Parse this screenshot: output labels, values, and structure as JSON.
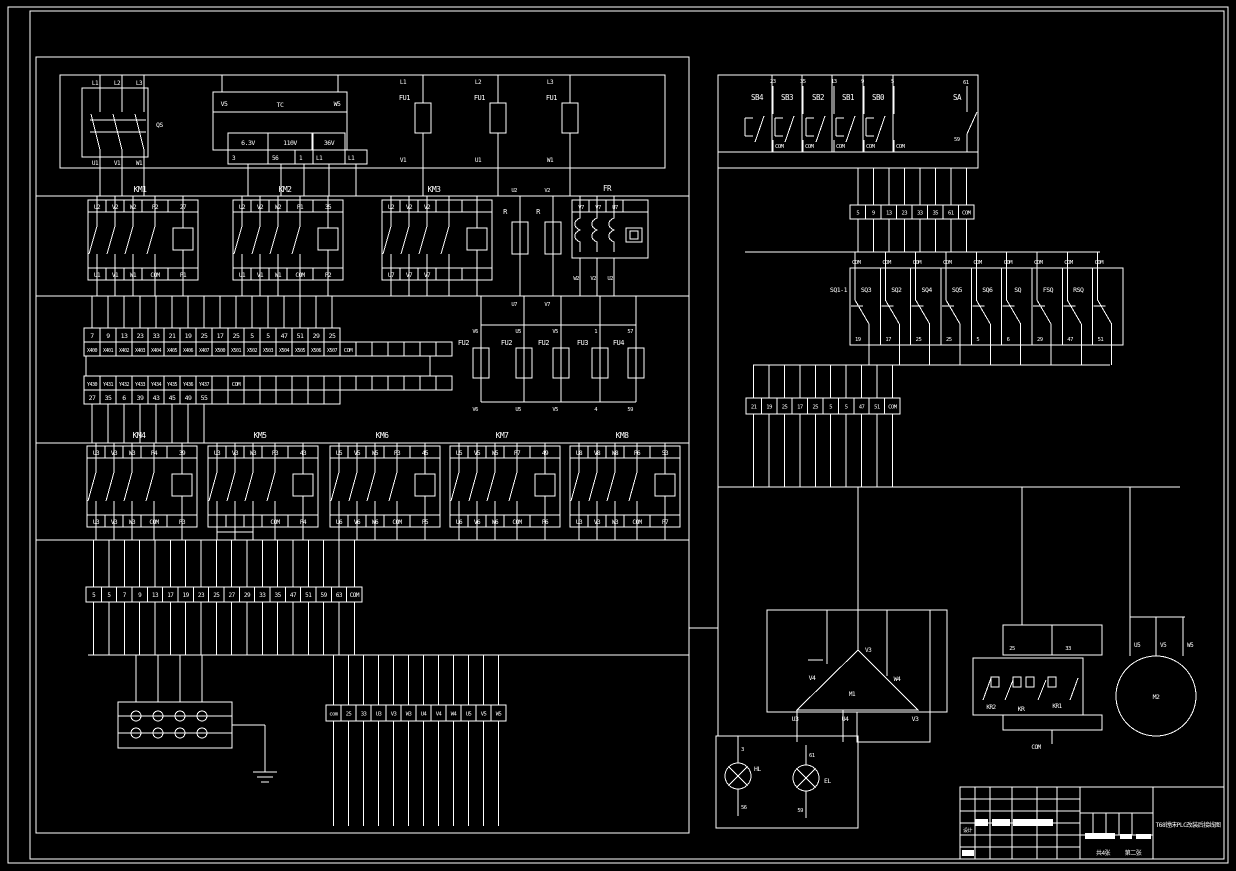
{
  "drawing": {
    "colors": {
      "background": "#000000",
      "line": "#ffffff"
    },
    "left": {
      "qs": {
        "label": "QS",
        "top": [
          "L1",
          "L2",
          "L3"
        ],
        "bottom": [
          "U1",
          "V1",
          "W1"
        ]
      },
      "tc": {
        "label": "TC",
        "left_terminal": "V5",
        "right_terminal": "W5",
        "taps": [
          "6.3V",
          "110V",
          "36V"
        ],
        "terminals": [
          "3",
          "56",
          "1",
          "L1",
          "L1"
        ]
      },
      "fu1": {
        "labels": [
          "FU1",
          "FU1",
          "FU1"
        ],
        "tops": [
          "L1",
          "L2",
          "L3"
        ],
        "bottoms": [
          "V1",
          "U1",
          "W1"
        ]
      },
      "km_row1": [
        {
          "label": "KM1",
          "top": [
            "U2",
            "V2",
            "W2",
            "P2",
            "27"
          ],
          "bottom": [
            "U1",
            "V1",
            "W1",
            "COM",
            "P1"
          ]
        },
        {
          "label": "KM2",
          "top": [
            "U2",
            "V2",
            "W2",
            "P1",
            "35"
          ],
          "bottom": [
            "U1",
            "V1",
            "W1",
            "COM",
            "P2"
          ]
        },
        {
          "label": "KM3",
          "top": [
            "U2",
            "V2",
            "V2",
            "",
            ""
          ],
          "bottom": [
            "U7",
            "V7",
            "V7",
            "",
            ""
          ]
        }
      ],
      "resistors": [
        {
          "label": "R",
          "top": "U2",
          "bottom": "U7"
        },
        {
          "label": "R",
          "top": "V2",
          "bottom": "V7"
        }
      ],
      "fr": {
        "label": "FR",
        "top": [
          "V7",
          "V7",
          "U7"
        ],
        "bottom": [
          "W2",
          "V2",
          "U2"
        ]
      },
      "plc": {
        "top_numbers": [
          "7",
          "9",
          "13",
          "23",
          "33",
          "21",
          "19",
          "25",
          "17",
          "25",
          "5",
          "5",
          "47",
          "51",
          "29",
          "25"
        ],
        "x_labels": [
          "X400",
          "X401",
          "X402",
          "X403",
          "X404",
          "X405",
          "X406",
          "X407",
          "X500",
          "X501",
          "X502",
          "X503",
          "X504",
          "X505",
          "X506",
          "X507"
        ],
        "x_com": "COM",
        "y_labels": [
          "Y430",
          "Y431",
          "Y432",
          "Y433",
          "Y434",
          "Y435",
          "Y436",
          "Y437"
        ],
        "y_com": "COM",
        "bottom_numbers": [
          "27",
          "35",
          "6",
          "39",
          "43",
          "45",
          "49",
          "55"
        ]
      },
      "fuses2": [
        {
          "label": "FU2",
          "top": "V6",
          "bottom": "V6"
        },
        {
          "label": "FU2",
          "top": "U5",
          "bottom": "U5"
        },
        {
          "label": "FU2",
          "top": "V5",
          "bottom": "V5"
        },
        {
          "label": "FU3",
          "top": "1",
          "bottom": "4"
        },
        {
          "label": "FU4",
          "top": "57",
          "bottom": "59"
        }
      ],
      "km_row2": [
        {
          "label": "KM4",
          "top": [
            "U3",
            "V3",
            "W3",
            "P4",
            "39"
          ],
          "bottom": [
            "U3",
            "V3",
            "W3",
            "COM",
            "P3"
          ]
        },
        {
          "label": "KM5",
          "top": [
            "U3",
            "V3",
            "W3",
            "P3",
            "43"
          ],
          "bottom": [
            "",
            "",
            "",
            "COM",
            "P4"
          ]
        },
        {
          "label": "KM6",
          "top": [
            "U5",
            "V5",
            "W5",
            "P3",
            "45"
          ],
          "bottom": [
            "U6",
            "V6",
            "W6",
            "COM",
            "P5"
          ]
        },
        {
          "label": "KM7",
          "top": [
            "U5",
            "V5",
            "W5",
            "P7",
            "49"
          ],
          "bottom": [
            "U6",
            "V6",
            "W6",
            "COM",
            "P6"
          ]
        },
        {
          "label": "KM8",
          "top": [
            "U8",
            "V8",
            "W8",
            "P6",
            "53"
          ],
          "bottom": [
            "U3",
            "V3",
            "W3",
            "COM",
            "P7"
          ]
        }
      ],
      "strip_bottom": [
        "5",
        "5",
        "7",
        "9",
        "13",
        "17",
        "19",
        "23",
        "25",
        "27",
        "29",
        "33",
        "35",
        "47",
        "51",
        "59",
        "63",
        "COM"
      ],
      "strip_mid": [
        "com",
        "25",
        "33",
        "U3",
        "V3",
        "W3",
        "U4",
        "V4",
        "W4",
        "U5",
        "V5",
        "W5"
      ]
    },
    "right": {
      "buttons": [
        {
          "label": "SB4",
          "top": "23",
          "bottom": "COM"
        },
        {
          "label": "SB3",
          "top": "35",
          "bottom": "COM"
        },
        {
          "label": "SB2",
          "top": "13",
          "bottom": "COM"
        },
        {
          "label": "SB1",
          "top": "9",
          "bottom": "COM"
        },
        {
          "label": "SB0",
          "top": "5",
          "bottom": "COM"
        }
      ],
      "sa": {
        "label": "SA",
        "top": "61",
        "bottom": "59"
      },
      "strip1": [
        "5",
        "9",
        "13",
        "23",
        "33",
        "35",
        "61",
        "COM"
      ],
      "sq_switches": [
        {
          "label": "SQ1-1",
          "com": "COM",
          "num": "19"
        },
        {
          "label": "SQ3",
          "com": "COM",
          "num": "17"
        },
        {
          "label": "SQ2",
          "com": "COM",
          "num": "25"
        },
        {
          "label": "SQ4",
          "com": "COM",
          "num": "25"
        },
        {
          "label": "SQ5",
          "com": "COM",
          "num": "5"
        },
        {
          "label": "SQ6",
          "com": "COM",
          "num": "6"
        },
        {
          "label": "SQ",
          "com": "COM",
          "num": "29"
        },
        {
          "label": "FSQ",
          "com": "COM",
          "num": "47"
        },
        {
          "label": "RSQ",
          "com": "COM",
          "num": "51"
        }
      ],
      "strip2": [
        "21",
        "19",
        "25",
        "17",
        "25",
        "5",
        "5",
        "47",
        "51",
        "COM"
      ],
      "m1": {
        "label": "M1",
        "apex": "V3",
        "left": "V4",
        "right": "W4",
        "bottom": [
          "U3",
          "U4",
          "V3"
        ]
      },
      "kr": {
        "top": [
          "25",
          "33"
        ],
        "labels": [
          "KR2",
          "KR",
          "KR1"
        ],
        "bottom": "COM"
      },
      "m2": {
        "label": "M2",
        "terminals": [
          "U5",
          "V5",
          "W5"
        ]
      },
      "hl": {
        "label": "HL",
        "top": "3",
        "bottom": "56"
      },
      "el": {
        "label": "EL",
        "top": "61",
        "bottom": "59"
      }
    },
    "title_block": {
      "title": "T68镗床PLC改装后接线图",
      "sheet_total": "共4张",
      "sheet_no": "第二张",
      "design_label": "设计"
    }
  }
}
